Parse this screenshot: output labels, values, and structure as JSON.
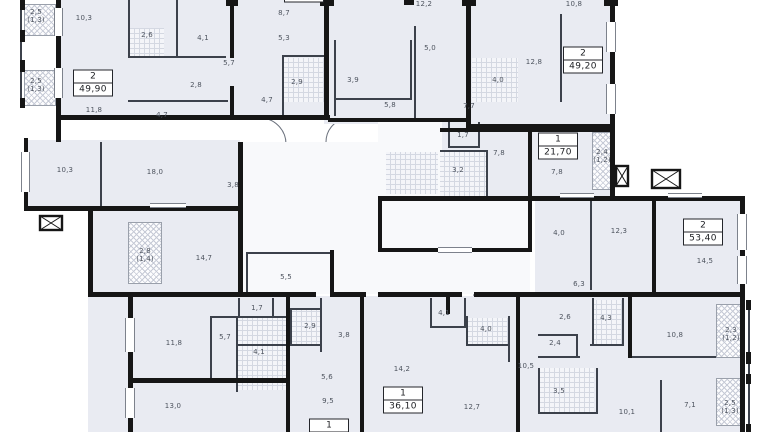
{
  "title": "residential floor plan",
  "colors": {
    "floor": "#e9ebf2",
    "wall": "#161616",
    "label": "#4d535e",
    "tile_line": "#d4d8e2",
    "hatch_line": "#c6cad6"
  },
  "rooms": [
    {
      "label": "2,5",
      "sub": "(1,3)",
      "x": 36,
      "y": 16
    },
    {
      "label": "10,3",
      "x": 84,
      "y": 18
    },
    {
      "label": "2,6",
      "x": 147,
      "y": 35
    },
    {
      "label": "4,1",
      "x": 203,
      "y": 38
    },
    {
      "label": "5,7",
      "x": 229,
      "y": 63
    },
    {
      "label": "2,8",
      "x": 196,
      "y": 85
    },
    {
      "label": "2,5",
      "sub": "(1,3)",
      "x": 36,
      "y": 85
    },
    {
      "label": "11,8",
      "x": 94,
      "y": 110
    },
    {
      "label": "4,7",
      "x": 162,
      "y": 115
    },
    {
      "label": "8,7",
      "x": 284,
      "y": 13
    },
    {
      "label": "5,3",
      "x": 284,
      "y": 38
    },
    {
      "label": "2,9",
      "x": 297,
      "y": 82
    },
    {
      "label": "4,7",
      "x": 267,
      "y": 100
    },
    {
      "label": "3,9",
      "x": 353,
      "y": 80
    },
    {
      "label": "5,8",
      "x": 390,
      "y": 105
    },
    {
      "label": "5,0",
      "x": 430,
      "y": 48
    },
    {
      "label": "12,2",
      "x": 424,
      "y": 4
    },
    {
      "label": "4,0",
      "x": 498,
      "y": 80
    },
    {
      "label": "7,7",
      "x": 469,
      "y": 106
    },
    {
      "label": "12,8",
      "x": 534,
      "y": 62
    },
    {
      "label": "10,8",
      "x": 574,
      "y": 4
    },
    {
      "label": "1,7",
      "x": 463,
      "y": 135
    },
    {
      "label": "7,8",
      "x": 499,
      "y": 153
    },
    {
      "label": "7,8",
      "x": 557,
      "y": 172
    },
    {
      "label": "3,2",
      "x": 458,
      "y": 170
    },
    {
      "label": "2,4",
      "sub": "(1,2)",
      "x": 602,
      "y": 156
    },
    {
      "label": "10,3",
      "x": 65,
      "y": 170
    },
    {
      "label": "18,0",
      "x": 155,
      "y": 172
    },
    {
      "label": "3,8",
      "x": 233,
      "y": 185
    },
    {
      "label": "2,8",
      "sub": "(1,4)",
      "x": 145,
      "y": 255
    },
    {
      "label": "14,7",
      "x": 204,
      "y": 258
    },
    {
      "label": "5,5",
      "x": 286,
      "y": 277
    },
    {
      "label": "4,0",
      "x": 559,
      "y": 233
    },
    {
      "label": "12,3",
      "x": 619,
      "y": 231
    },
    {
      "label": "14,5",
      "x": 705,
      "y": 261
    },
    {
      "label": "6,3",
      "x": 579,
      "y": 284
    },
    {
      "label": "1,7",
      "x": 257,
      "y": 308
    },
    {
      "label": "2,9",
      "x": 310,
      "y": 326
    },
    {
      "label": "3,8",
      "x": 344,
      "y": 335
    },
    {
      "label": "5,7",
      "x": 225,
      "y": 337
    },
    {
      "label": "4,1",
      "x": 259,
      "y": 352
    },
    {
      "label": "11,8",
      "x": 174,
      "y": 343
    },
    {
      "label": "13,0",
      "x": 173,
      "y": 406
    },
    {
      "label": "5,6",
      "x": 327,
      "y": 377
    },
    {
      "label": "9,5",
      "x": 328,
      "y": 401
    },
    {
      "label": "4,1",
      "x": 444,
      "y": 313
    },
    {
      "label": "4,0",
      "x": 486,
      "y": 329
    },
    {
      "label": "14,2",
      "x": 402,
      "y": 369
    },
    {
      "label": "12,7",
      "x": 472,
      "y": 407
    },
    {
      "label": "2,6",
      "x": 565,
      "y": 317
    },
    {
      "label": "4,3",
      "x": 606,
      "y": 318
    },
    {
      "label": "2,4",
      "x": 555,
      "y": 343
    },
    {
      "label": "10,5",
      "x": 526,
      "y": 366
    },
    {
      "label": "3,5",
      "x": 559,
      "y": 391
    },
    {
      "label": "10,8",
      "x": 675,
      "y": 335
    },
    {
      "label": "2,3",
      "sub": "(1,2)",
      "x": 731,
      "y": 334
    },
    {
      "label": "10,1",
      "x": 627,
      "y": 412
    },
    {
      "label": "7,1",
      "x": 690,
      "y": 405
    },
    {
      "label": "2,5",
      "sub": "(1,3)",
      "x": 730,
      "y": 407
    }
  ],
  "apartments": [
    {
      "rooms": "2",
      "area": "49,90",
      "x": 93,
      "y": 83
    },
    {
      "rooms": "",
      "area": "25,00",
      "x": 304,
      "y": -5
    },
    {
      "rooms": "2",
      "area": "49,20",
      "x": 583,
      "y": 60
    },
    {
      "rooms": "1",
      "area": "21,70",
      "x": 558,
      "y": 146
    },
    {
      "rooms": "2",
      "area": "53,40",
      "x": 703,
      "y": 232
    },
    {
      "rooms": "1",
      "area": "36,10",
      "x": 403,
      "y": 400
    },
    {
      "rooms": "1",
      "area": "",
      "x": 329,
      "y": 426
    }
  ]
}
